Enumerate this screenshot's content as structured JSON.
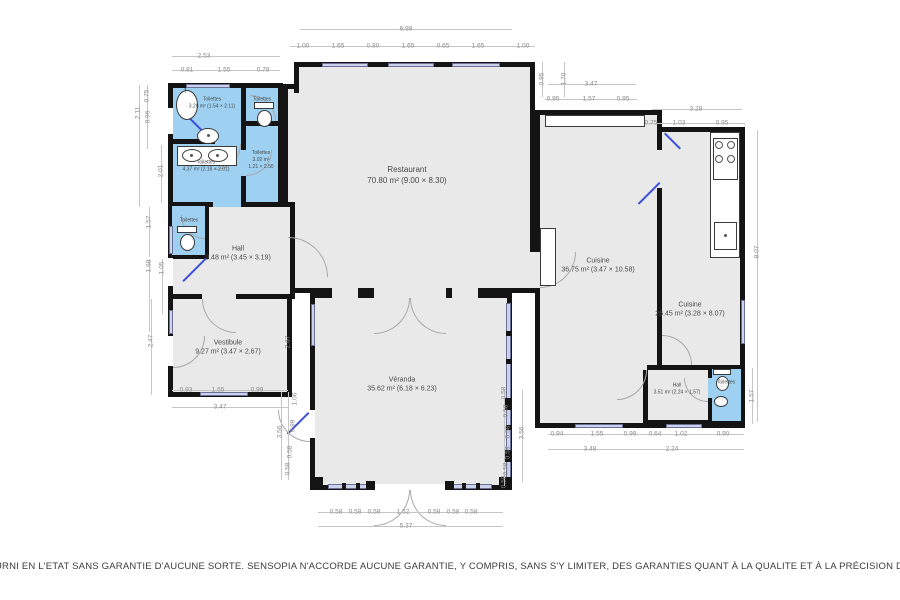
{
  "rooms": {
    "restaurant": {
      "name": "Restaurant",
      "size": "70.80 m² (9.00 × 8.30)"
    },
    "cuisine_main": {
      "name": "Cuisine",
      "size": "36.75 m² (3.47 × 10.58)"
    },
    "cuisine_right": {
      "name": "Cuisine",
      "size": "26.45 m² (3.28 × 8.07)"
    },
    "veranda": {
      "name": "Véranda",
      "size": "35.62 m² (6.18 × 6.23)"
    },
    "vestibule": {
      "name": "Vestibule",
      "size": "9.27 m² (3.47 × 2.67)"
    },
    "hall": {
      "name": "Hall",
      "size": "9.48 m² (3.45 × 3.19)"
    },
    "hall_small": {
      "name": "Hall",
      "size": "3.51 m² (2.24 × 1.57)"
    },
    "wc_top": {
      "name": "Toilettes",
      "size": "3.26 m² (1.54 × 2.11)"
    },
    "wc_mid": {
      "name": "Toilettes",
      "size": "4.37 m² (2.18 × 2.01)"
    },
    "wc_right": {
      "name": "Toilettes",
      "size": "3.02 m²",
      "size2": "1.21 × 2.50"
    },
    "wc_tr": {
      "name": "Toilettes"
    },
    "wc_small": {
      "name": "Toilettes"
    },
    "wc_br": {
      "name": "Toilettes"
    }
  },
  "icons": {
    "arrow_up": "↑"
  },
  "colors": {
    "wall": "#141414",
    "room_fill": "#e9e9e9",
    "wet_room_fill": "#9dd0f1",
    "window_fill": "#cdd2ef",
    "door_leaf": "#3a50d9",
    "dim_text": "#8a8a8a",
    "label_text": "#4a4a4a",
    "disclaimer_text": "#3c3c3c"
  },
  "disclaimer": "URNI EN L'ETAT SANS GARANTIE D'AUCUNE SORTE. SENSOPIA N'ACCORDE AUCUNE GARANTIE, Y COMPRIS, SANS S'Y LIMITER, DES GARANTIES QUANT À LA QUALITE ET À LA PRÉCISION DES DIMENSIONS.",
  "dimensions": [
    {
      "t": "2.53",
      "x": 204,
      "y": 56
    },
    {
      "t": "0.81",
      "x": 187,
      "y": 70
    },
    {
      "t": "1.55",
      "x": 224,
      "y": 70
    },
    {
      "t": "0.78",
      "x": 263,
      "y": 70
    },
    {
      "t": "6.98",
      "x": 406,
      "y": 29
    },
    {
      "t": "1.00",
      "x": 303,
      "y": 46
    },
    {
      "t": "1.65",
      "x": 338,
      "y": 46
    },
    {
      "t": "0.80",
      "x": 373,
      "y": 46
    },
    {
      "t": "1.65",
      "x": 408,
      "y": 46
    },
    {
      "t": "0.65",
      "x": 443,
      "y": 46
    },
    {
      "t": "1.65",
      "x": 478,
      "y": 46
    },
    {
      "t": "1.00",
      "x": 523,
      "y": 46
    },
    {
      "t": "3.47",
      "x": 591,
      "y": 84
    },
    {
      "t": "0.95",
      "x": 553,
      "y": 99
    },
    {
      "t": "1.57",
      "x": 589,
      "y": 99
    },
    {
      "t": "0.95",
      "x": 623,
      "y": 99
    },
    {
      "t": "3.28",
      "x": 696,
      "y": 109
    },
    {
      "t": "0.75",
      "x": 651,
      "y": 123
    },
    {
      "t": "1.03",
      "x": 679,
      "y": 123
    },
    {
      "t": "0.95",
      "x": 722,
      "y": 123
    },
    {
      "t": "0.95",
      "x": 542,
      "y": 79,
      "r": 1
    },
    {
      "t": "1.70",
      "x": 564,
      "y": 79,
      "r": 1
    },
    {
      "t": "0.75",
      "x": 147,
      "y": 96,
      "r": 1
    },
    {
      "t": "2.11",
      "x": 138,
      "y": 113,
      "r": 1
    },
    {
      "t": "0.96",
      "x": 148,
      "y": 117,
      "r": 1
    },
    {
      "t": "2.01",
      "x": 161,
      "y": 171,
      "r": 1
    },
    {
      "t": "1.57",
      "x": 149,
      "y": 222,
      "r": 1
    },
    {
      "t": "1.68",
      "x": 149,
      "y": 266,
      "r": 1
    },
    {
      "t": "1.05",
      "x": 162,
      "y": 268,
      "r": 1
    },
    {
      "t": "2.47",
      "x": 151,
      "y": 341,
      "r": 1
    },
    {
      "t": "0.93",
      "x": 186,
      "y": 390
    },
    {
      "t": "1.55",
      "x": 218,
      "y": 390
    },
    {
      "t": "0.99",
      "x": 257,
      "y": 390
    },
    {
      "t": "3.47",
      "x": 220,
      "y": 407
    },
    {
      "t": "2.67",
      "x": 288,
      "y": 342,
      "r": 1
    },
    {
      "t": "1.06",
      "x": 295,
      "y": 399,
      "r": 1
    },
    {
      "t": "0.99",
      "x": 293,
      "y": 426,
      "r": 1
    },
    {
      "t": "0.58",
      "x": 290,
      "y": 452,
      "r": 1
    },
    {
      "t": "0.58",
      "x": 288,
      "y": 469,
      "r": 1
    },
    {
      "t": "3.56",
      "x": 280,
      "y": 432,
      "r": 1
    },
    {
      "t": "0.58",
      "x": 504,
      "y": 393,
      "r": 1
    },
    {
      "t": "0.58",
      "x": 506,
      "y": 411,
      "r": 1
    },
    {
      "t": "0.58",
      "x": 508,
      "y": 432,
      "r": 1
    },
    {
      "t": "0.58",
      "x": 508,
      "y": 453,
      "r": 1
    },
    {
      "t": "0.58",
      "x": 506,
      "y": 469,
      "r": 1
    },
    {
      "t": "0.58",
      "x": 504,
      "y": 482,
      "r": 1
    },
    {
      "t": "3.56",
      "x": 522,
      "y": 433,
      "r": 1
    },
    {
      "t": "0.58",
      "x": 336,
      "y": 512
    },
    {
      "t": "0.58",
      "x": 355,
      "y": 512
    },
    {
      "t": "0.58",
      "x": 374,
      "y": 512
    },
    {
      "t": "1.52",
      "x": 403,
      "y": 512
    },
    {
      "t": "0.58",
      "x": 434,
      "y": 512
    },
    {
      "t": "0.58",
      "x": 453,
      "y": 512
    },
    {
      "t": "0.58",
      "x": 471,
      "y": 512
    },
    {
      "t": "5.37",
      "x": 406,
      "y": 526
    },
    {
      "t": "8.07",
      "x": 757,
      "y": 252,
      "r": 1
    },
    {
      "t": "1.57",
      "x": 752,
      "y": 396,
      "r": 1
    },
    {
      "t": "0.94",
      "x": 557,
      "y": 434
    },
    {
      "t": "1.55",
      "x": 597,
      "y": 434
    },
    {
      "t": "0.99",
      "x": 630,
      "y": 434
    },
    {
      "t": "0.64",
      "x": 655,
      "y": 434
    },
    {
      "t": "1.02",
      "x": 681,
      "y": 434
    },
    {
      "t": "0.90",
      "x": 723,
      "y": 434
    },
    {
      "t": "3.48",
      "x": 590,
      "y": 449
    },
    {
      "t": "2.24",
      "x": 672,
      "y": 449
    }
  ],
  "dimension_lines": [
    [
      172,
      56,
      108,
      1
    ],
    [
      172,
      70,
      108,
      1
    ],
    [
      300,
      29,
      212,
      1
    ],
    [
      290,
      46,
      245,
      1
    ],
    [
      548,
      84,
      88,
      1
    ],
    [
      545,
      99,
      92,
      1
    ],
    [
      652,
      109,
      90,
      1
    ],
    [
      645,
      123,
      100,
      1
    ],
    [
      139,
      85,
      1,
      122
    ],
    [
      147,
      85,
      1,
      64
    ],
    [
      161,
      145,
      1,
      58
    ],
    [
      149,
      207,
      1,
      50
    ],
    [
      149,
      259,
      1,
      73
    ],
    [
      162,
      259,
      1,
      55
    ],
    [
      151,
      299,
      1,
      96
    ],
    [
      542,
      62,
      1,
      35
    ],
    [
      564,
      62,
      1,
      35
    ],
    [
      172,
      390,
      116,
      1
    ],
    [
      172,
      407,
      116,
      1
    ],
    [
      281,
      392,
      1,
      88
    ],
    [
      288,
      392,
      1,
      88
    ],
    [
      504,
      390,
      1,
      96
    ],
    [
      522,
      390,
      1,
      92
    ],
    [
      318,
      512,
      185,
      1
    ],
    [
      318,
      526,
      185,
      1
    ],
    [
      548,
      434,
      196,
      1
    ],
    [
      548,
      449,
      196,
      1
    ],
    [
      757,
      130,
      1,
      292
    ],
    [
      752,
      368,
      1,
      56
    ]
  ]
}
